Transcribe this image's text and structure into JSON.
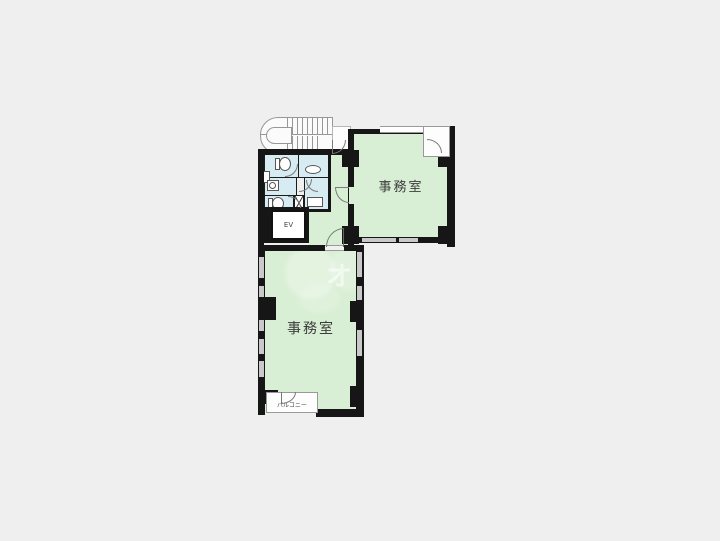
{
  "floor_plan": {
    "rooms": [
      {
        "id": "office-upper",
        "label": "事務室"
      },
      {
        "id": "office-lower",
        "label": "事務室"
      },
      {
        "id": "elevator",
        "label": "EV"
      },
      {
        "id": "balcony",
        "label": "バルコニー"
      }
    ],
    "watermark": {
      "glyph": "オ"
    },
    "colors": {
      "background": "#efefef",
      "office_fill": "#d9efd5",
      "wet_area_fill": "#d6ebf2",
      "wall": "#161616",
      "window": "#c9c9c9",
      "stair_line": "#979797",
      "label_text": "#3c3c3c"
    }
  }
}
